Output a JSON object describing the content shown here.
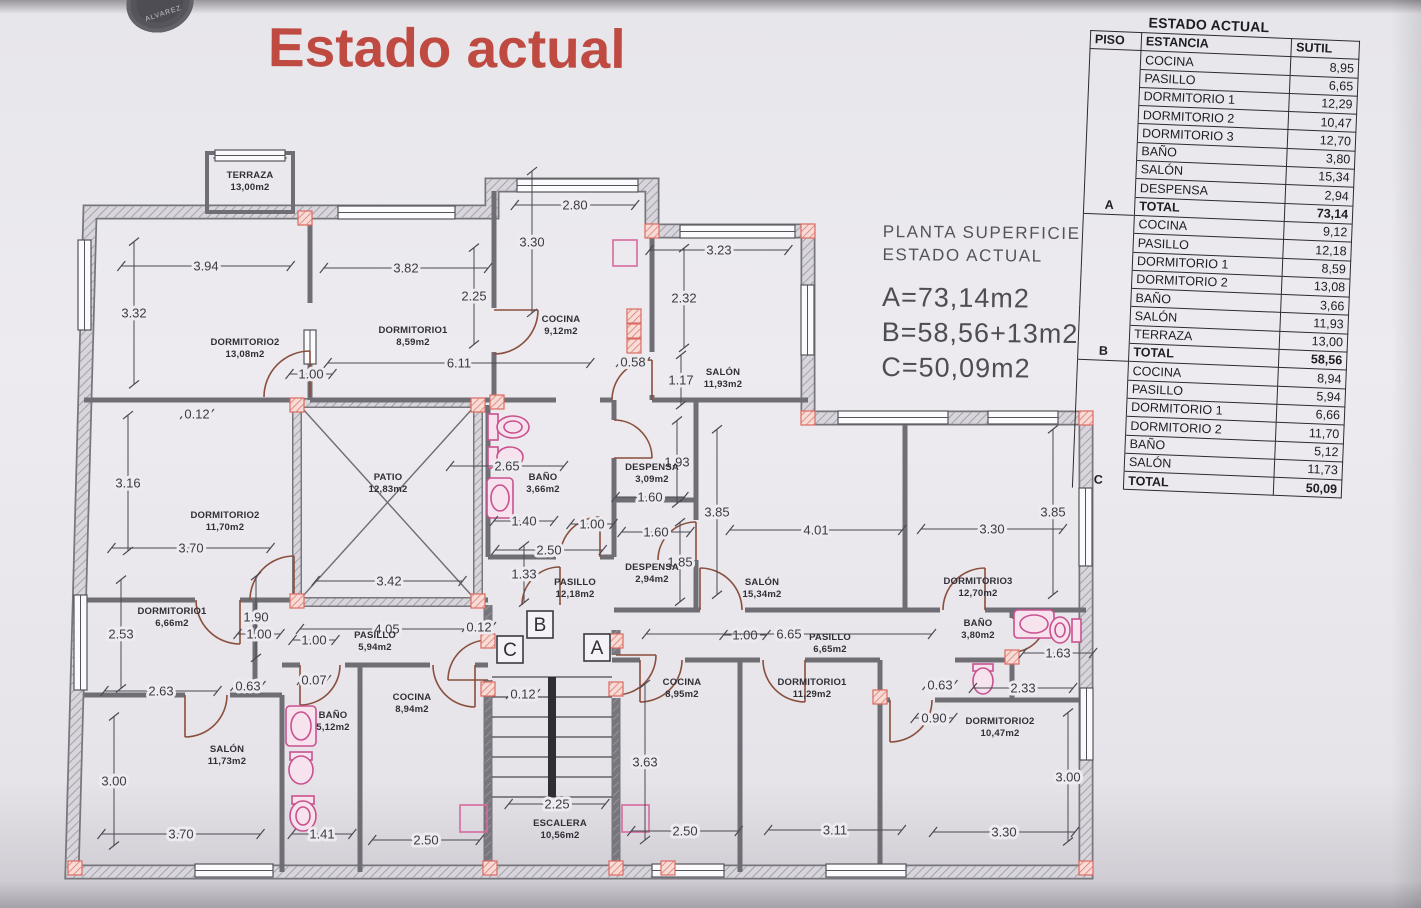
{
  "title": "Estado actual",
  "stamp": {
    "text": "ALVAREZ"
  },
  "annotation": {
    "line1": "PLANTA SUPERFICIE",
    "line2": "ESTADO ACTUAL",
    "area_a": "A=73,14m2",
    "area_b": "B=58,56+13m2",
    "area_c": "C=50,09m2"
  },
  "table": {
    "title": "ESTADO ACTUAL",
    "columns": [
      "PISO",
      "ESTANCIA",
      "SUTIL"
    ],
    "total_label": "TOTAL",
    "sections": [
      {
        "piso": "A",
        "rows": [
          [
            "COCINA",
            "8,95"
          ],
          [
            "PASILLO",
            "6,65"
          ],
          [
            "DORMITORIO 1",
            "12,29"
          ],
          [
            "DORMITORIO 2",
            "10,47"
          ],
          [
            "DORMITORIO 3",
            "12,70"
          ],
          [
            "BAÑO",
            "3,80"
          ],
          [
            "SALÓN",
            "15,34"
          ],
          [
            "DESPENSA",
            "2,94"
          ],
          [
            "TOTAL",
            "73,14"
          ]
        ]
      },
      {
        "piso": "B",
        "rows": [
          [
            "COCINA",
            "9,12"
          ],
          [
            "PASILLO",
            "12,18"
          ],
          [
            "DORMITORIO 1",
            "8,59"
          ],
          [
            "DORMITORIO 2",
            "13,08"
          ],
          [
            "BAÑO",
            "3,66"
          ],
          [
            "SALÓN",
            "11,93"
          ],
          [
            "TERRAZA",
            "13,00"
          ],
          [
            "TOTAL",
            "58,56"
          ]
        ]
      },
      {
        "piso": "C",
        "rows": [
          [
            "COCINA",
            "8,94"
          ],
          [
            "PASILLO",
            "5,94"
          ],
          [
            "DORMITORIO 1",
            "6,66"
          ],
          [
            "DORMITORIO 2",
            "11,70"
          ],
          [
            "BAÑO",
            "5,12"
          ],
          [
            "SALÓN",
            "11,73"
          ],
          [
            "TOTAL",
            "50,09"
          ]
        ]
      }
    ]
  },
  "plan": {
    "room_labels": [
      {
        "name": "TERRAZA",
        "area": "13,00m2",
        "x": 250,
        "y": 178
      },
      {
        "name": "DORMITORIO2",
        "area": "13,08m2",
        "x": 245,
        "y": 345
      },
      {
        "name": "DORMITORIO1",
        "area": "8,59m2",
        "x": 413,
        "y": 333
      },
      {
        "name": "COCINA",
        "area": "9,12m2",
        "x": 561,
        "y": 322
      },
      {
        "name": "SALÓN",
        "area": "11,93m2",
        "x": 723,
        "y": 375
      },
      {
        "name": "PATIO",
        "area": "12,83m2",
        "x": 388,
        "y": 480
      },
      {
        "name": "BAÑO",
        "area": "3,66m2",
        "x": 543,
        "y": 480
      },
      {
        "name": "DESPENSA",
        "area": "3,09m2",
        "x": 652,
        "y": 470
      },
      {
        "name": "DORMITORIO2",
        "area": "11,70m2",
        "x": 225,
        "y": 518
      },
      {
        "name": "PASILLO",
        "area": "12,18m2",
        "x": 575,
        "y": 585
      },
      {
        "name": "DESPENSA",
        "area": "2,94m2",
        "x": 652,
        "y": 570
      },
      {
        "name": "SALÓN",
        "area": "15,34m2",
        "x": 762,
        "y": 585
      },
      {
        "name": "DORMITORIO3",
        "area": "12,70m2",
        "x": 978,
        "y": 584
      },
      {
        "name": "DORMITORIO1",
        "area": "6,66m2",
        "x": 172,
        "y": 614
      },
      {
        "name": "PASILLO",
        "area": "5,94m2",
        "x": 375,
        "y": 638
      },
      {
        "name": "BAÑO",
        "area": "3,80m2",
        "x": 978,
        "y": 626
      },
      {
        "name": "PASILLO",
        "area": "6,65m2",
        "x": 830,
        "y": 640
      },
      {
        "name": "COCINA",
        "area": "8,94m2",
        "x": 412,
        "y": 700
      },
      {
        "name": "COCINA",
        "area": "8,95m2",
        "x": 682,
        "y": 685
      },
      {
        "name": "DORMITORIO1",
        "area": "11,29m2",
        "x": 812,
        "y": 685
      },
      {
        "name": "BAÑO",
        "area": "5,12m2",
        "x": 333,
        "y": 718
      },
      {
        "name": "DORMITORIO2",
        "area": "10,47m2",
        "x": 1000,
        "y": 724
      },
      {
        "name": "SALÓN",
        "area": "11,73m2",
        "x": 227,
        "y": 752
      },
      {
        "name": "ESCALERA",
        "area": "10,56m2",
        "x": 560,
        "y": 826
      }
    ],
    "dimensions": [
      {
        "t": "2.80",
        "x": 575,
        "y": 205,
        "o": "h"
      },
      {
        "t": "3.30",
        "x": 532,
        "y": 242,
        "o": "v"
      },
      {
        "t": "3.94",
        "x": 206,
        "y": 266,
        "o": "h"
      },
      {
        "t": "3.82",
        "x": 406,
        "y": 268,
        "o": "h"
      },
      {
        "t": "2.25",
        "x": 474,
        "y": 296,
        "o": "v"
      },
      {
        "t": "3.23",
        "x": 719,
        "y": 250,
        "o": "h"
      },
      {
        "t": "2.32",
        "x": 684,
        "y": 298,
        "o": "v"
      },
      {
        "t": "3.32",
        "x": 134,
        "y": 313,
        "o": "v"
      },
      {
        "t": "6.11",
        "x": 459,
        "y": 363,
        "o": "h"
      },
      {
        "t": "0.58",
        "x": 633,
        "y": 362,
        "o": "h"
      },
      {
        "t": "1.00",
        "x": 311,
        "y": 374,
        "o": "h"
      },
      {
        "t": "1.17",
        "x": 681,
        "y": 380,
        "o": "v"
      },
      {
        "t": "0.12",
        "x": 197,
        "y": 414,
        "o": "h"
      },
      {
        "t": "2.65",
        "x": 507,
        "y": 466,
        "o": "h"
      },
      {
        "t": "1.93",
        "x": 677,
        "y": 462,
        "o": "v"
      },
      {
        "t": "3.16",
        "x": 128,
        "y": 483,
        "o": "v"
      },
      {
        "t": "1.60",
        "x": 650,
        "y": 497,
        "o": "h"
      },
      {
        "t": "1.40",
        "x": 524,
        "y": 521,
        "o": "h"
      },
      {
        "t": "1.00",
        "x": 592,
        "y": 524,
        "o": "h"
      },
      {
        "t": "1.60",
        "x": 656,
        "y": 532,
        "o": "h"
      },
      {
        "t": "3.85",
        "x": 717,
        "y": 512,
        "o": "v"
      },
      {
        "t": "4.01",
        "x": 816,
        "y": 530,
        "o": "h"
      },
      {
        "t": "3.30",
        "x": 992,
        "y": 529,
        "o": "h"
      },
      {
        "t": "3.85",
        "x": 1053,
        "y": 512,
        "o": "v"
      },
      {
        "t": "3.70",
        "x": 191,
        "y": 548,
        "o": "h"
      },
      {
        "t": "2.50",
        "x": 549,
        "y": 550,
        "o": "h"
      },
      {
        "t": "1.33",
        "x": 524,
        "y": 574,
        "o": "v"
      },
      {
        "t": "1.85",
        "x": 680,
        "y": 562,
        "o": "v"
      },
      {
        "t": "3.42",
        "x": 389,
        "y": 581,
        "o": "h"
      },
      {
        "t": "1.90",
        "x": 256,
        "y": 617,
        "o": "v"
      },
      {
        "t": "1.00",
        "x": 259,
        "y": 634,
        "o": "h"
      },
      {
        "t": "2.53",
        "x": 121,
        "y": 634,
        "o": "v"
      },
      {
        "t": "1.00",
        "x": 314,
        "y": 640,
        "o": "h"
      },
      {
        "t": "4.05",
        "x": 387,
        "y": 629,
        "o": "h"
      },
      {
        "t": "0.12",
        "x": 479,
        "y": 627,
        "o": "h"
      },
      {
        "t": "1.00",
        "x": 745,
        "y": 635,
        "o": "h"
      },
      {
        "t": "6.65",
        "x": 789,
        "y": 634,
        "o": "h"
      },
      {
        "t": "1.63",
        "x": 1058,
        "y": 653,
        "o": "h"
      },
      {
        "t": "2.63",
        "x": 161,
        "y": 691,
        "o": "h"
      },
      {
        "t": "0.63",
        "x": 248,
        "y": 686,
        "o": "h"
      },
      {
        "t": "0.07",
        "x": 314,
        "y": 680,
        "o": "h"
      },
      {
        "t": "0.12",
        "x": 523,
        "y": 694,
        "o": "h"
      },
      {
        "t": "0.63",
        "x": 940,
        "y": 685,
        "o": "h"
      },
      {
        "t": "2.33",
        "x": 1023,
        "y": 688,
        "o": "h"
      },
      {
        "t": "0.90",
        "x": 934,
        "y": 718,
        "o": "h"
      },
      {
        "t": "3.00",
        "x": 114,
        "y": 781,
        "o": "v"
      },
      {
        "t": "3.63",
        "x": 645,
        "y": 762,
        "o": "v"
      },
      {
        "t": "2.25",
        "x": 557,
        "y": 804,
        "o": "h"
      },
      {
        "t": "3.70",
        "x": 181,
        "y": 834,
        "o": "h"
      },
      {
        "t": "1.41",
        "x": 322,
        "y": 834,
        "o": "h"
      },
      {
        "t": "2.50",
        "x": 426,
        "y": 840,
        "o": "h"
      },
      {
        "t": "2.50",
        "x": 685,
        "y": 831,
        "o": "h"
      },
      {
        "t": "3.11",
        "x": 835,
        "y": 830,
        "o": "h"
      },
      {
        "t": "3.30",
        "x": 1004,
        "y": 832,
        "o": "h"
      },
      {
        "t": "3.00",
        "x": 1068,
        "y": 777,
        "o": "v"
      }
    ],
    "unit_marks": [
      {
        "t": "B",
        "x": 540,
        "y": 625
      },
      {
        "t": "C",
        "x": 510,
        "y": 650
      },
      {
        "t": "A",
        "x": 597,
        "y": 648
      }
    ]
  }
}
